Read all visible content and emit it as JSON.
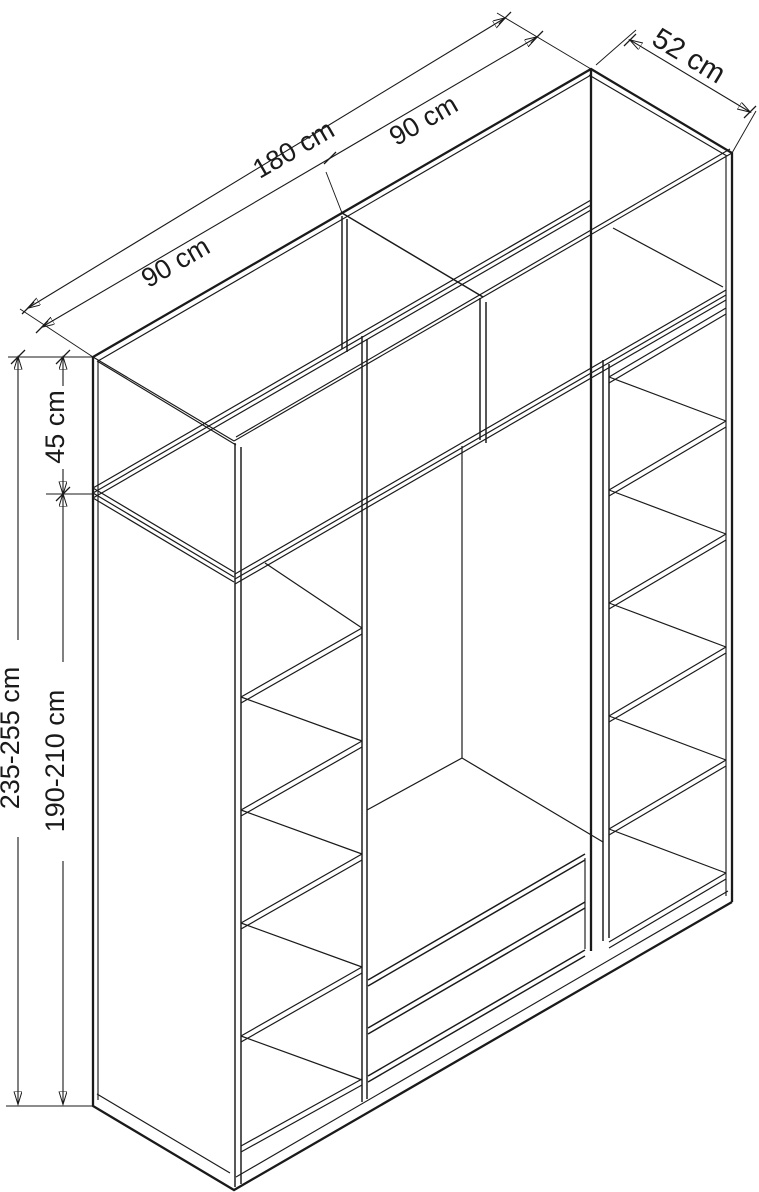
{
  "diagram": {
    "type": "furniture-dimension-diagram",
    "subject": "wardrobe-isometric-view",
    "colors": {
      "line_color": "#1a1a1a",
      "background": "#ffffff"
    },
    "dimensions": {
      "top_width_left": "90 cm",
      "top_width_total": "180 cm",
      "top_width_right": "90 cm",
      "depth": "52 cm",
      "upper_section_height": "45 cm",
      "total_height": "235-255 cm",
      "lower_section_height": "190-210 cm"
    }
  }
}
